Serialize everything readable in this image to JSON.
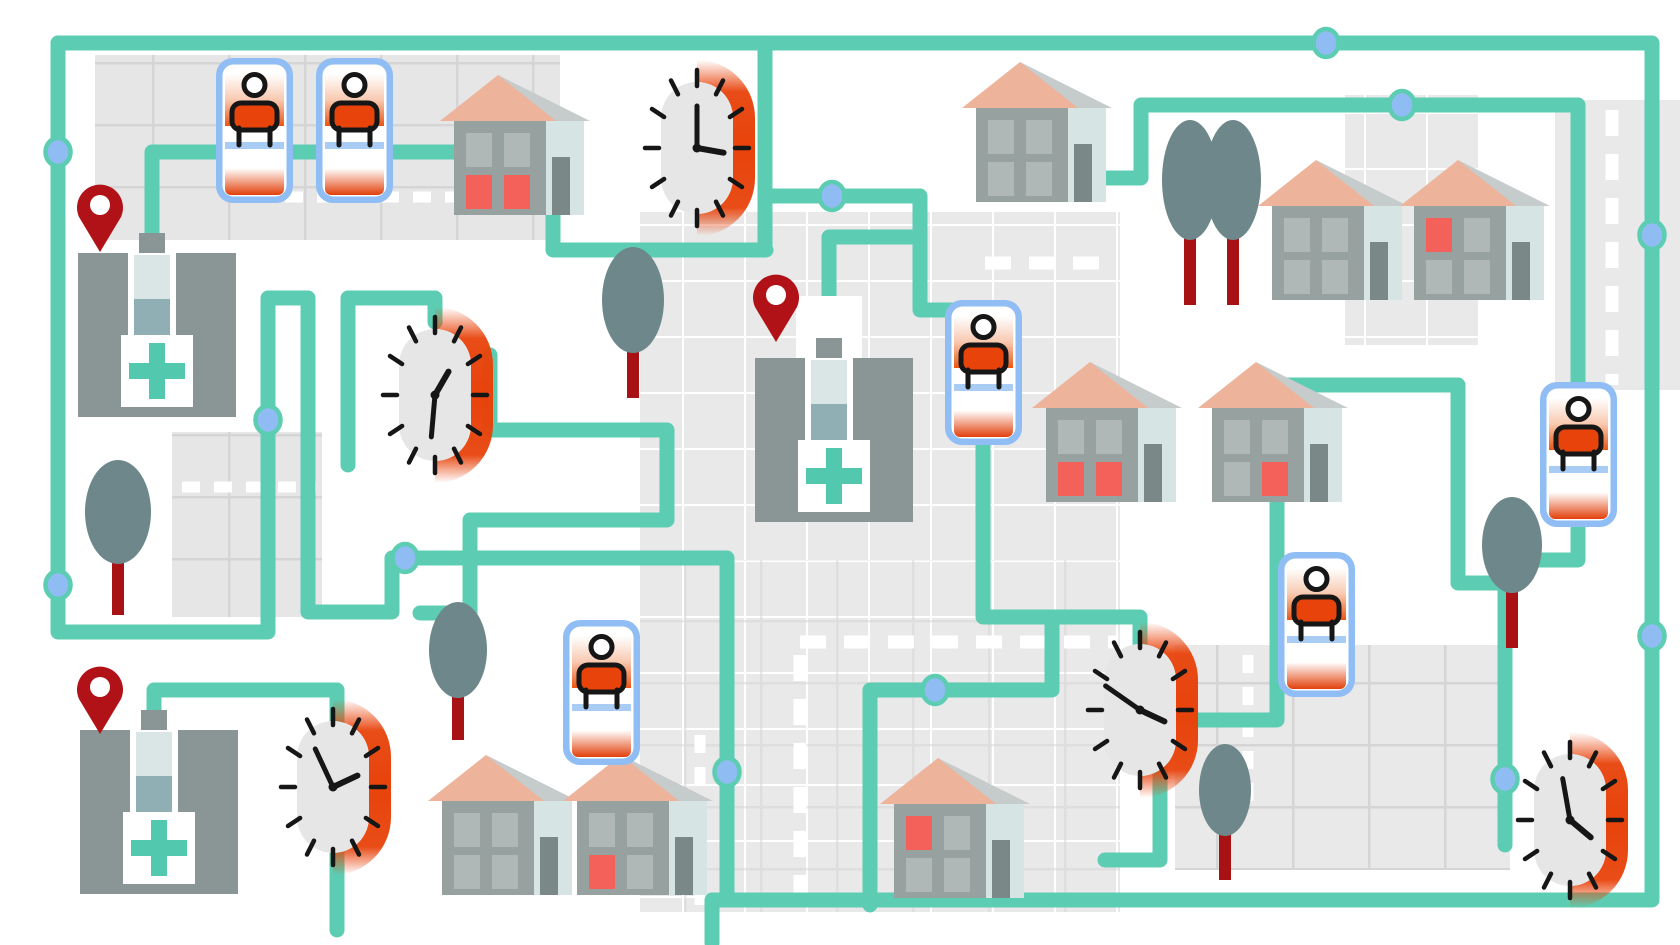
{
  "app": {
    "name": "home-care-route-map-illustration",
    "kind": "editorial illustration, stylized street map",
    "background": "#FFFFFF"
  },
  "palette": {
    "teal": "#5CCDB2",
    "node-blue": "#8FBCF2",
    "bed-blue": "#8FBDF4",
    "orange": "#E8430B",
    "pin-red": "#B01217",
    "trunk-red": "#A81215",
    "tree-green": "#6E878A",
    "hospital-gray": "#8A9595",
    "tower-light": "#DAE5E5",
    "tower-teal": "#8FAFB4",
    "cross-teal": "#52C8AE",
    "cross-box": "#FFFFFF",
    "house-gray": "#97A1A0",
    "window-gray": "#AFB8B7",
    "window-red": "#F4605A",
    "door-light": "#D6E5E4",
    "door-dark": "#7A8887",
    "roof-salmon": "#EDB39B",
    "roof-gray": "#C6CCCB",
    "block-gray": "#E6E6E6",
    "block-light": "#E9E9E9",
    "grid-dark": "#D5D5D5",
    "clock-face": "#E6E6E6",
    "ink": "#161616",
    "sheet-blue": "#A9CCF4",
    "road-white": "#FFFFFF"
  },
  "legend": {
    "hospitals": 3,
    "location_pins": 3,
    "patient_beds": 6,
    "clocks": 5,
    "houses": 9,
    "trees": 7,
    "route_nodes": 12,
    "route_color_note": "teal winding routes connect hospitals, beds and houses"
  },
  "hospitals": [
    {
      "id": "hospital-top-left",
      "has_pin": true,
      "cross": true
    },
    {
      "id": "hospital-center",
      "has_pin": true,
      "cross": true
    },
    {
      "id": "hospital-bottom-left",
      "has_pin": true,
      "cross": true
    }
  ],
  "beds": [
    {
      "id": "bed-top-left-1",
      "patient": true
    },
    {
      "id": "bed-top-left-2",
      "patient": true
    },
    {
      "id": "bed-center",
      "patient": true
    },
    {
      "id": "bed-center-bottom",
      "patient": true
    },
    {
      "id": "bed-right",
      "patient": true
    },
    {
      "id": "bed-far-right",
      "patient": true
    }
  ],
  "clocks": [
    {
      "id": "clock-top-middle",
      "hour_transform": "rotate(100)",
      "minute_transform": "rotate(0)"
    },
    {
      "id": "clock-mid-left",
      "hour_transform": "rotate(30)",
      "minute_transform": "rotate(185)"
    },
    {
      "id": "clock-bottom-left",
      "hour_transform": "rotate(65)",
      "minute_transform": "rotate(335)"
    },
    {
      "id": "clock-center-right",
      "hour_transform": "rotate(115)",
      "minute_transform": "rotate(305)"
    },
    {
      "id": "clock-bottom-right",
      "hour_transform": "rotate(130)",
      "minute_transform": "rotate(350)"
    }
  ],
  "houses": [
    {
      "id": "house-top-left",
      "red_windows": [
        "bottom-left",
        "bottom-right"
      ]
    },
    {
      "id": "house-top-center",
      "red_windows": []
    },
    {
      "id": "house-top-right-1",
      "red_windows": []
    },
    {
      "id": "house-top-right-2",
      "red_windows": [
        "top-left"
      ]
    },
    {
      "id": "house-mid-right-1",
      "red_windows": [
        "bottom-left",
        "bottom-right"
      ]
    },
    {
      "id": "house-mid-right-2",
      "red_windows": [
        "bottom-right"
      ]
    },
    {
      "id": "house-bottom-left-1",
      "red_windows": []
    },
    {
      "id": "house-bottom-left-2",
      "red_windows": [
        "bottom-left"
      ]
    },
    {
      "id": "house-bottom-center",
      "red_windows": [
        "top-left"
      ]
    }
  ]
}
